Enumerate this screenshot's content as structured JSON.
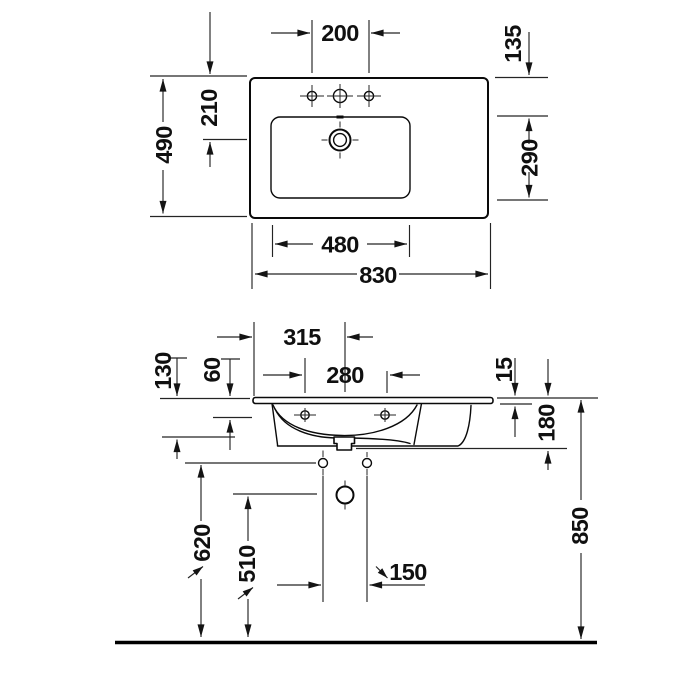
{
  "accent_color": "#0a0a0a",
  "top_view": {
    "hole_spacing": "200",
    "rear_offset": "135",
    "depth_overall": "490",
    "rear_to_drain": "210",
    "bowl_depth": "290",
    "bowl_width": "480",
    "width_overall": "830"
  },
  "front_view": {
    "edge_to_center": "315",
    "fixing_hole_spacing": "280",
    "front_height": "130",
    "top_to_fixing_hole": "60",
    "rim_thickness": "15",
    "ceramic_height": "180",
    "outlet_height": "620",
    "trap_height": "510",
    "pipe_spacing": "150",
    "rim_height": "850"
  }
}
